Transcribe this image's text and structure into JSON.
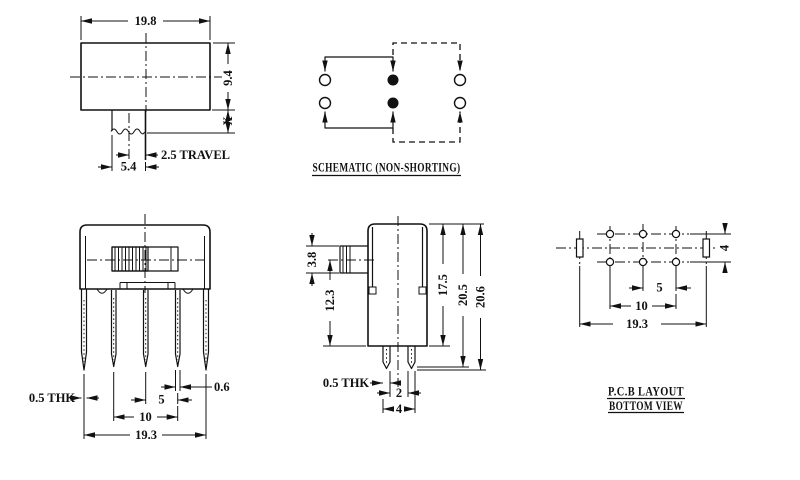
{
  "colors": {
    "line": "#111111",
    "background": "#ffffff"
  },
  "top_view": {
    "dim_width": "19.8",
    "dim_height": "9.4",
    "dim_x": "X",
    "dim_travel": "2.5 TRAVEL",
    "dim_knob": "5.4"
  },
  "schematic": {
    "title": "SCHEMATIC (NON-SHORTING)"
  },
  "front_view": {
    "dim_thk": "0.5 THK",
    "dim_pin_width": "0.6",
    "dim_pitch": "5",
    "dim_span": "10",
    "dim_total": "19.3"
  },
  "side_view": {
    "dim_knob_height": "3.8",
    "dim_knob_to_base": "12.3",
    "dim_body_height": "17.5",
    "dim_height_1": "20.5",
    "dim_height_2": "20.6",
    "dim_thk": "0.5 THK",
    "dim_pin_gap": "2",
    "dim_pin_span": "4"
  },
  "pcb": {
    "dim_row_spacing": "4",
    "dim_pitch": "5",
    "dim_span": "10",
    "dim_total": "19.3",
    "label_line1": "P.C.B LAYOUT",
    "label_line2": "BOTTOM VIEW"
  }
}
